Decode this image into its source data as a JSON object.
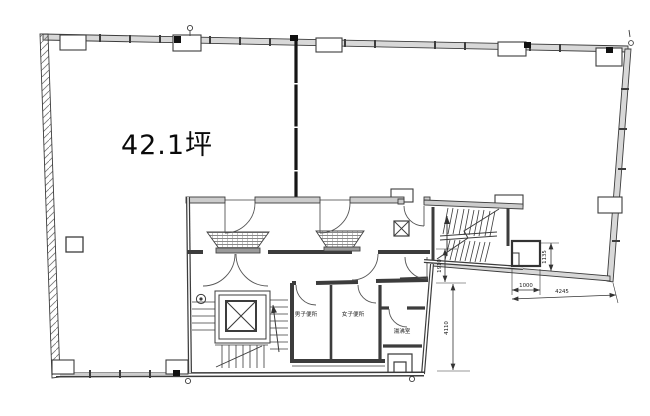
{
  "plan": {
    "area_label": "42.1坪",
    "rooms": {
      "mens_toilet": "男子便所",
      "womens_toilet": "女子便所",
      "kitchenette": "湯沸室"
    },
    "dimensions": {
      "width_small": "1000",
      "width_large": "4245",
      "height_right": "1135",
      "height_mid": "1910",
      "height_lower": "4110"
    },
    "colors": {
      "line": "#3c3c3c",
      "wall_fill": "#d8d8d8",
      "ink": "#111111",
      "background": "#ffffff"
    }
  }
}
